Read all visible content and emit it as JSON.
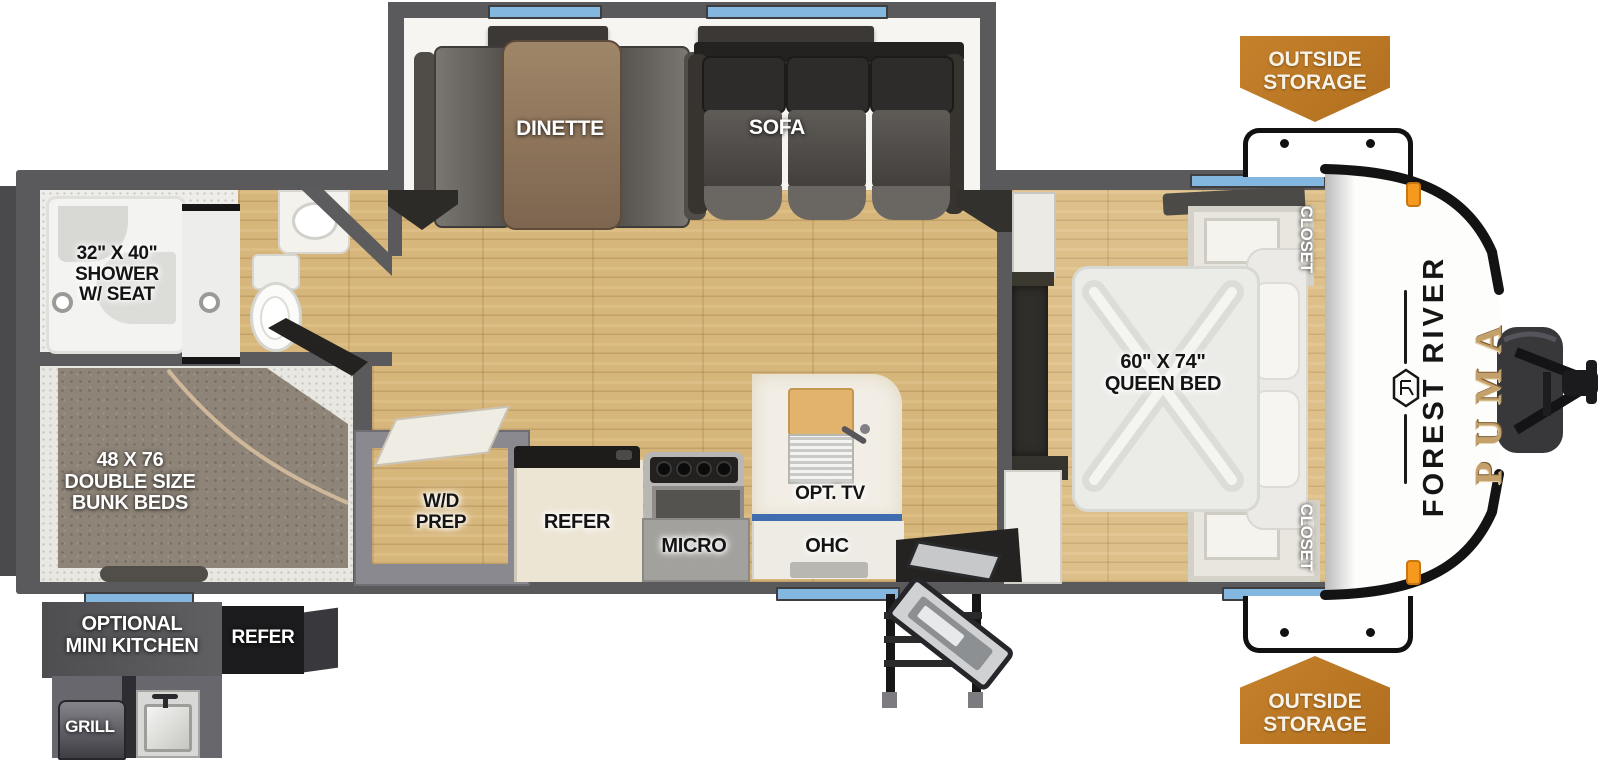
{
  "title": "Forest River Puma travel trailer floorplan",
  "brand": {
    "make": "FOREST RIVER",
    "model": "PUMA"
  },
  "exterior": {
    "storage_badge_top": "OUTSIDE\nSTORAGE",
    "storage_badge_bottom": "OUTSIDE\nSTORAGE",
    "mini_kitchen": {
      "label": "OPTIONAL\nMINI KITCHEN",
      "refer": "REFER",
      "grill": "GRILL"
    }
  },
  "rooms": {
    "slideout": {
      "dinette": "DINETTE",
      "sofa": "SOFA"
    },
    "bathroom": {
      "shower": "32\" X 40\"\nSHOWER\nW/ SEAT"
    },
    "bunkroom": {
      "bunks": "48 X 76\nDOUBLE SIZE\nBUNK BEDS"
    },
    "kitchen": {
      "wd_prep": "W/D\nPREP",
      "refer": "REFER",
      "micro": "MICRO",
      "ohc": "OHC",
      "opt_tv": "OPT. TV"
    },
    "bedroom": {
      "bed": "60\" X 74\"\nQUEEN BED",
      "closet_top": "CLOSET",
      "closet_bottom": "CLOSET"
    }
  },
  "colors": {
    "wall": "#5a5a5c",
    "bumper": "#4a4a4d",
    "window_blue": "#84b7e0",
    "badge_orange": "#bd7722",
    "floor_wood": "#d7b67c",
    "bedroom_wood": "#ddbf8a",
    "bunk_mattress": "#8e8478",
    "queen_mattress": "#ebebe8",
    "refer_cream": "#ece5d4",
    "counter_marble": "#f2eee6",
    "sofa_dark": "#2e2c2a",
    "puma_gold": "#c4a06a",
    "marker_light": "#f59a1f"
  }
}
